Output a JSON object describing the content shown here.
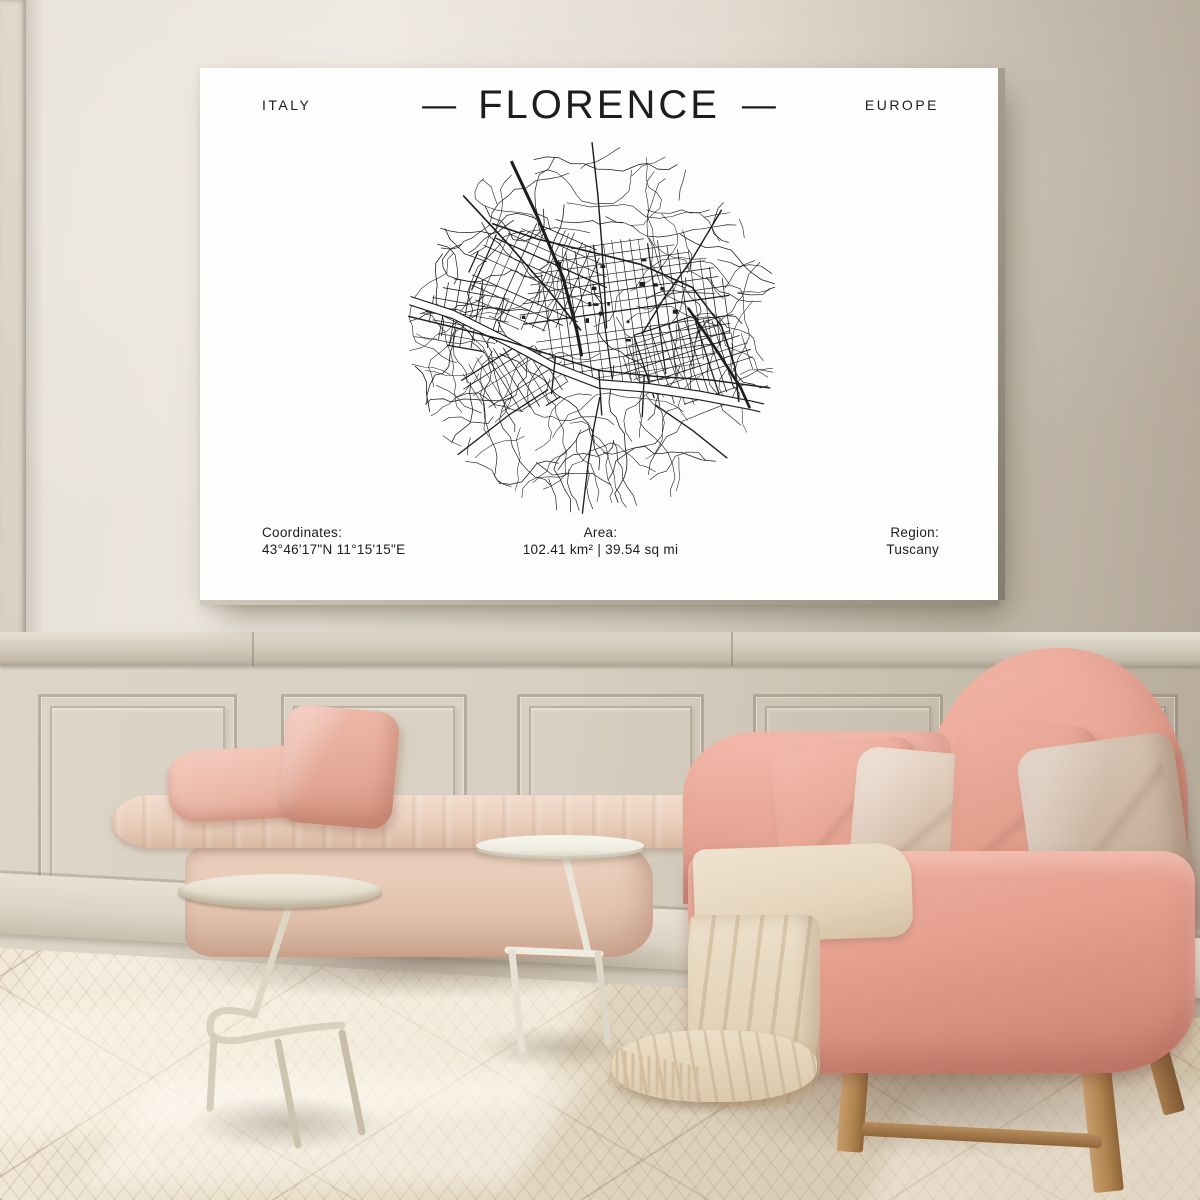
{
  "palette": {
    "ink": "#1d1d1d",
    "poster-white": "#fdfdfc",
    "wall-light": "#eae5dc",
    "wall-dark": "#b2a798",
    "floor-light": "#f1e8d6",
    "floor-mid": "#e2d6c0",
    "floor-dark": "#cfc0a8",
    "sofa-pink": "#e9a596",
    "bench-pink": "#ecd2c0",
    "pillow-cream": "#ddc9b8",
    "blanket-cream": "#e9dcc6",
    "wood": "#b48a5e"
  },
  "poster": {
    "country": "ITALY",
    "dash": "—",
    "title": "FLORENCE",
    "continent": "EUROPE",
    "footer": {
      "coordinates_label": "Coordinates:",
      "coordinates_value": "43°46'17\"N 11°15'15\"E",
      "area_label": "Area:",
      "area_value": "102.41 km² | 39.54 sq mi",
      "region_label": "Region:",
      "region_value": "Tuscany"
    },
    "map": {
      "seed": 11,
      "ink": "#1e1e1e",
      "organic": 130,
      "blocks": 16,
      "grids": [
        {
          "cx": 235,
          "cy": 182,
          "rx": 112,
          "ry": 76,
          "rot": -8,
          "step": 10
        },
        {
          "cx": 142,
          "cy": 148,
          "rx": 72,
          "ry": 56,
          "rot": 24,
          "step": 11
        },
        {
          "cx": 298,
          "cy": 234,
          "rx": 70,
          "ry": 46,
          "rot": -18,
          "step": 9
        },
        {
          "cx": 118,
          "cy": 252,
          "rx": 56,
          "ry": 36,
          "rot": -32,
          "step": 10
        },
        {
          "cx": 72,
          "cy": 186,
          "rx": 44,
          "ry": 40,
          "rot": 10,
          "step": 12
        }
      ],
      "river": [
        [
          4,
          170
        ],
        [
          54,
          186
        ],
        [
          110,
          214
        ],
        [
          158,
          240
        ],
        [
          205,
          258
        ],
        [
          256,
          262
        ],
        [
          310,
          270
        ],
        [
          362,
          280
        ],
        [
          397,
          288
        ]
      ],
      "roads": [
        {
          "p": [
            [
              95,
              92
            ],
            [
              142,
              108
            ],
            [
              192,
              120
            ],
            [
              248,
              134
            ],
            [
              302,
              158
            ],
            [
              332,
              198
            ],
            [
              346,
              240
            ],
            [
              350,
              276
            ]
          ],
          "w": 1.7
        },
        {
          "p": [
            [
              8,
              188
            ],
            [
              58,
              200
            ],
            [
              112,
              214
            ],
            [
              162,
              230
            ],
            [
              205,
              244
            ],
            [
              262,
              250
            ],
            [
              322,
              254
            ],
            [
              396,
              264
            ]
          ],
          "w": 1.5
        },
        {
          "p": [
            [
              60,
              58
            ],
            [
              112,
              114
            ],
            [
              152,
              160
            ],
            [
              186,
              202
            ]
          ],
          "w": 1.7
        },
        {
          "p": [
            [
              198,
              8
            ],
            [
              204,
              62
            ],
            [
              208,
              112
            ],
            [
              211,
              162
            ],
            [
              213,
              200
            ]
          ],
          "w": 1.5
        },
        {
          "p": [
            [
              332,
              78
            ],
            [
              302,
              128
            ],
            [
              272,
              170
            ],
            [
              250,
              206
            ]
          ],
          "w": 1.5
        },
        {
          "p": [
            [
              58,
              332
            ],
            [
              112,
              290
            ],
            [
              152,
              264
            ]
          ],
          "w": 1.4
        },
        {
          "p": [
            [
              188,
              392
            ],
            [
              194,
              340
            ],
            [
              200,
              302
            ],
            [
              206,
              272
            ]
          ],
          "w": 1.4
        },
        {
          "p": [
            [
              342,
              338
            ],
            [
              302,
              306
            ],
            [
              264,
              280
            ]
          ],
          "w": 1.4
        },
        {
          "p": [
            [
              205,
              244
            ],
            [
              208,
              290
            ]
          ],
          "w": 1.4
        },
        {
          "p": [
            [
              252,
              250
            ],
            [
              250,
              292
            ]
          ],
          "w": 1.4
        },
        {
          "p": [
            [
              160,
              230
            ],
            [
              156,
              268
            ]
          ],
          "w": 1.4
        },
        {
          "p": [
            [
              110,
              18
            ],
            [
              141,
              84
            ],
            [
              168,
              148
            ],
            [
              182,
              202
            ],
            [
              187,
              228
            ]
          ],
          "w": 3.2
        },
        {
          "p": [
            [
              298,
              180
            ],
            [
              329,
              226
            ],
            [
              352,
              262
            ],
            [
              361,
              282
            ]
          ],
          "w": 2.8
        }
      ]
    }
  }
}
